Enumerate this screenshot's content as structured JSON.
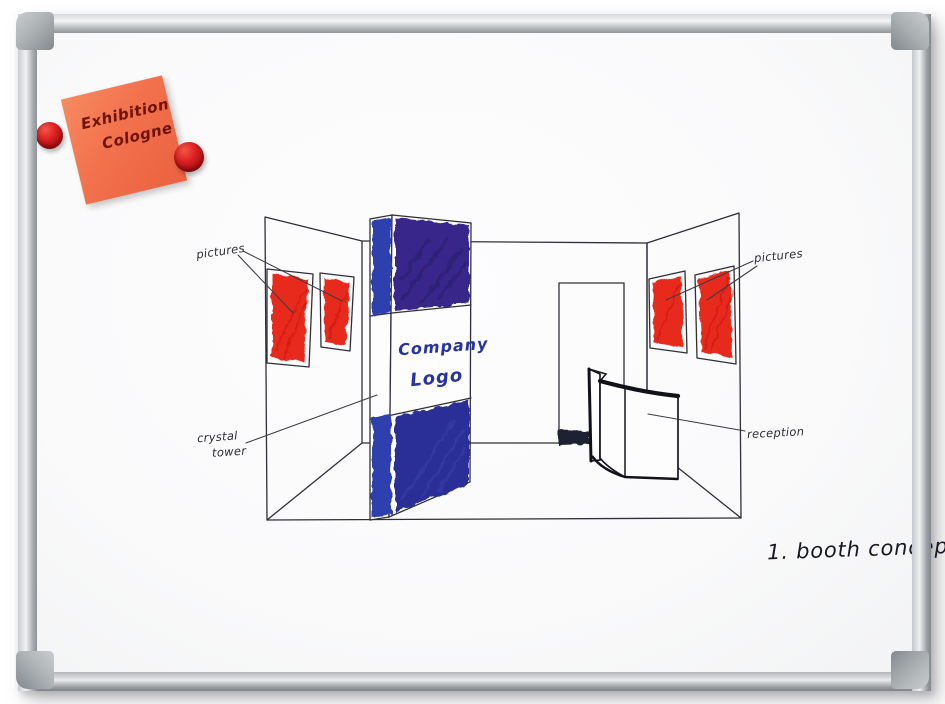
{
  "board": {
    "caption": "1. booth concept",
    "surface_color": "#fbfbfc",
    "frame_color": "#c9cccf"
  },
  "sticky_note": {
    "line1": "Exhibition",
    "line2": "Cologne",
    "color": "#f2714b",
    "ink_color": "#6e1309"
  },
  "magnets": {
    "count": 2,
    "color": "#c41a1a"
  },
  "sketch": {
    "tower": {
      "line1": "Company",
      "line2": "Logo"
    },
    "labels": {
      "pictures_left": "pictures",
      "pictures_right": "pictures",
      "crystal_line1": "crystal",
      "crystal_line2": "tower",
      "reception": "reception"
    },
    "colors": {
      "ink": "#2f2f3a",
      "marker_red": "#e8291c",
      "marker_blue": "#2e3fae",
      "marker_indigo": "#38288a",
      "marker_navy": "#2a2f97",
      "logo_blue": "#2733a2",
      "threshold_dark": "#1d2133"
    }
  }
}
